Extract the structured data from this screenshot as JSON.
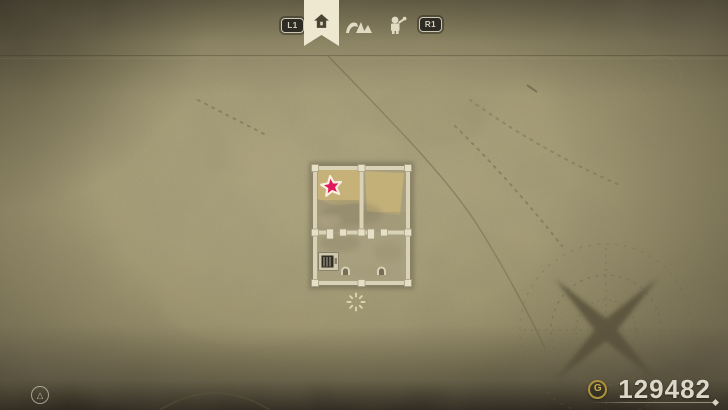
{
  "header": {
    "shoulder_left": "L1",
    "shoulder_right": "R1",
    "tabs": [
      {
        "id": "camp",
        "icon": "house-icon",
        "selected": true
      },
      {
        "id": "ruins",
        "icon": "ruins-icon",
        "selected": false
      },
      {
        "id": "machines",
        "icon": "machine-icon",
        "selected": false
      }
    ]
  },
  "map": {
    "markers": [
      {
        "type": "quest-star",
        "color": "#e2175c",
        "location": "top-left-room"
      },
      {
        "type": "shop-vending-machine",
        "location": "lower-room"
      },
      {
        "type": "player-position",
        "location": "south-of-building"
      }
    ],
    "decor": [
      "compass-rose",
      "dotted-trails",
      "faded-emblem",
      "faded-arc"
    ]
  },
  "footer": {
    "currency_symbol": "G",
    "currency_value": "129482",
    "hint_glyph": "△"
  },
  "colors": {
    "parchment": "#b0a77f",
    "wall_cream": "#d8d1b5",
    "banner_cream": "#efe8d1",
    "star_pink": "#e2175c",
    "coin_gold": "#ad923b",
    "currency_text": "#dbd8ca",
    "vignette_dark": "#1f1c14"
  }
}
